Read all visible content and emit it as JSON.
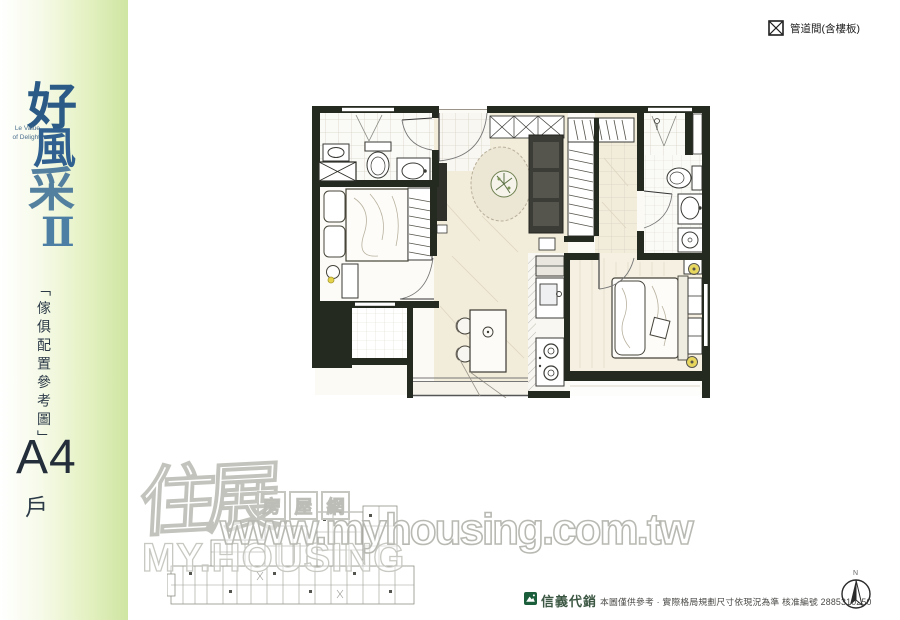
{
  "sidebar": {
    "brand_chars": [
      "好",
      "風",
      "采"
    ],
    "brand_numeral": "Ⅱ",
    "tagline_line1": "Le Value",
    "tagline_line2": "of Delight",
    "caption_vertical": "「傢俱配置參考圖」",
    "unit_code": "A4",
    "unit_suffix": "戶"
  },
  "legend": {
    "duct_label": "管道間(含樓板)"
  },
  "watermark": {
    "brand": "住展",
    "brand_sub_chars": [
      "房",
      "屋",
      "網"
    ],
    "latin": "MY.HOUSING",
    "url": "www.myhousing.com.tw"
  },
  "footer": {
    "agency": "信義代銷",
    "disclaimer": "本圖僅供參考 · 實際格局規劃尺寸依現況為準 核准編號 2885310250",
    "north_label": "N"
  },
  "colors": {
    "sidebar_green": "#cfe5a2",
    "brand_blue": "#2f6090",
    "wall_dark": "#252a21",
    "floor_warm": "#f2ecda",
    "lamp_yellow": "#e6d34c",
    "agency_green": "#1b5e3b",
    "watermark_gray": "#c3c3bd"
  }
}
